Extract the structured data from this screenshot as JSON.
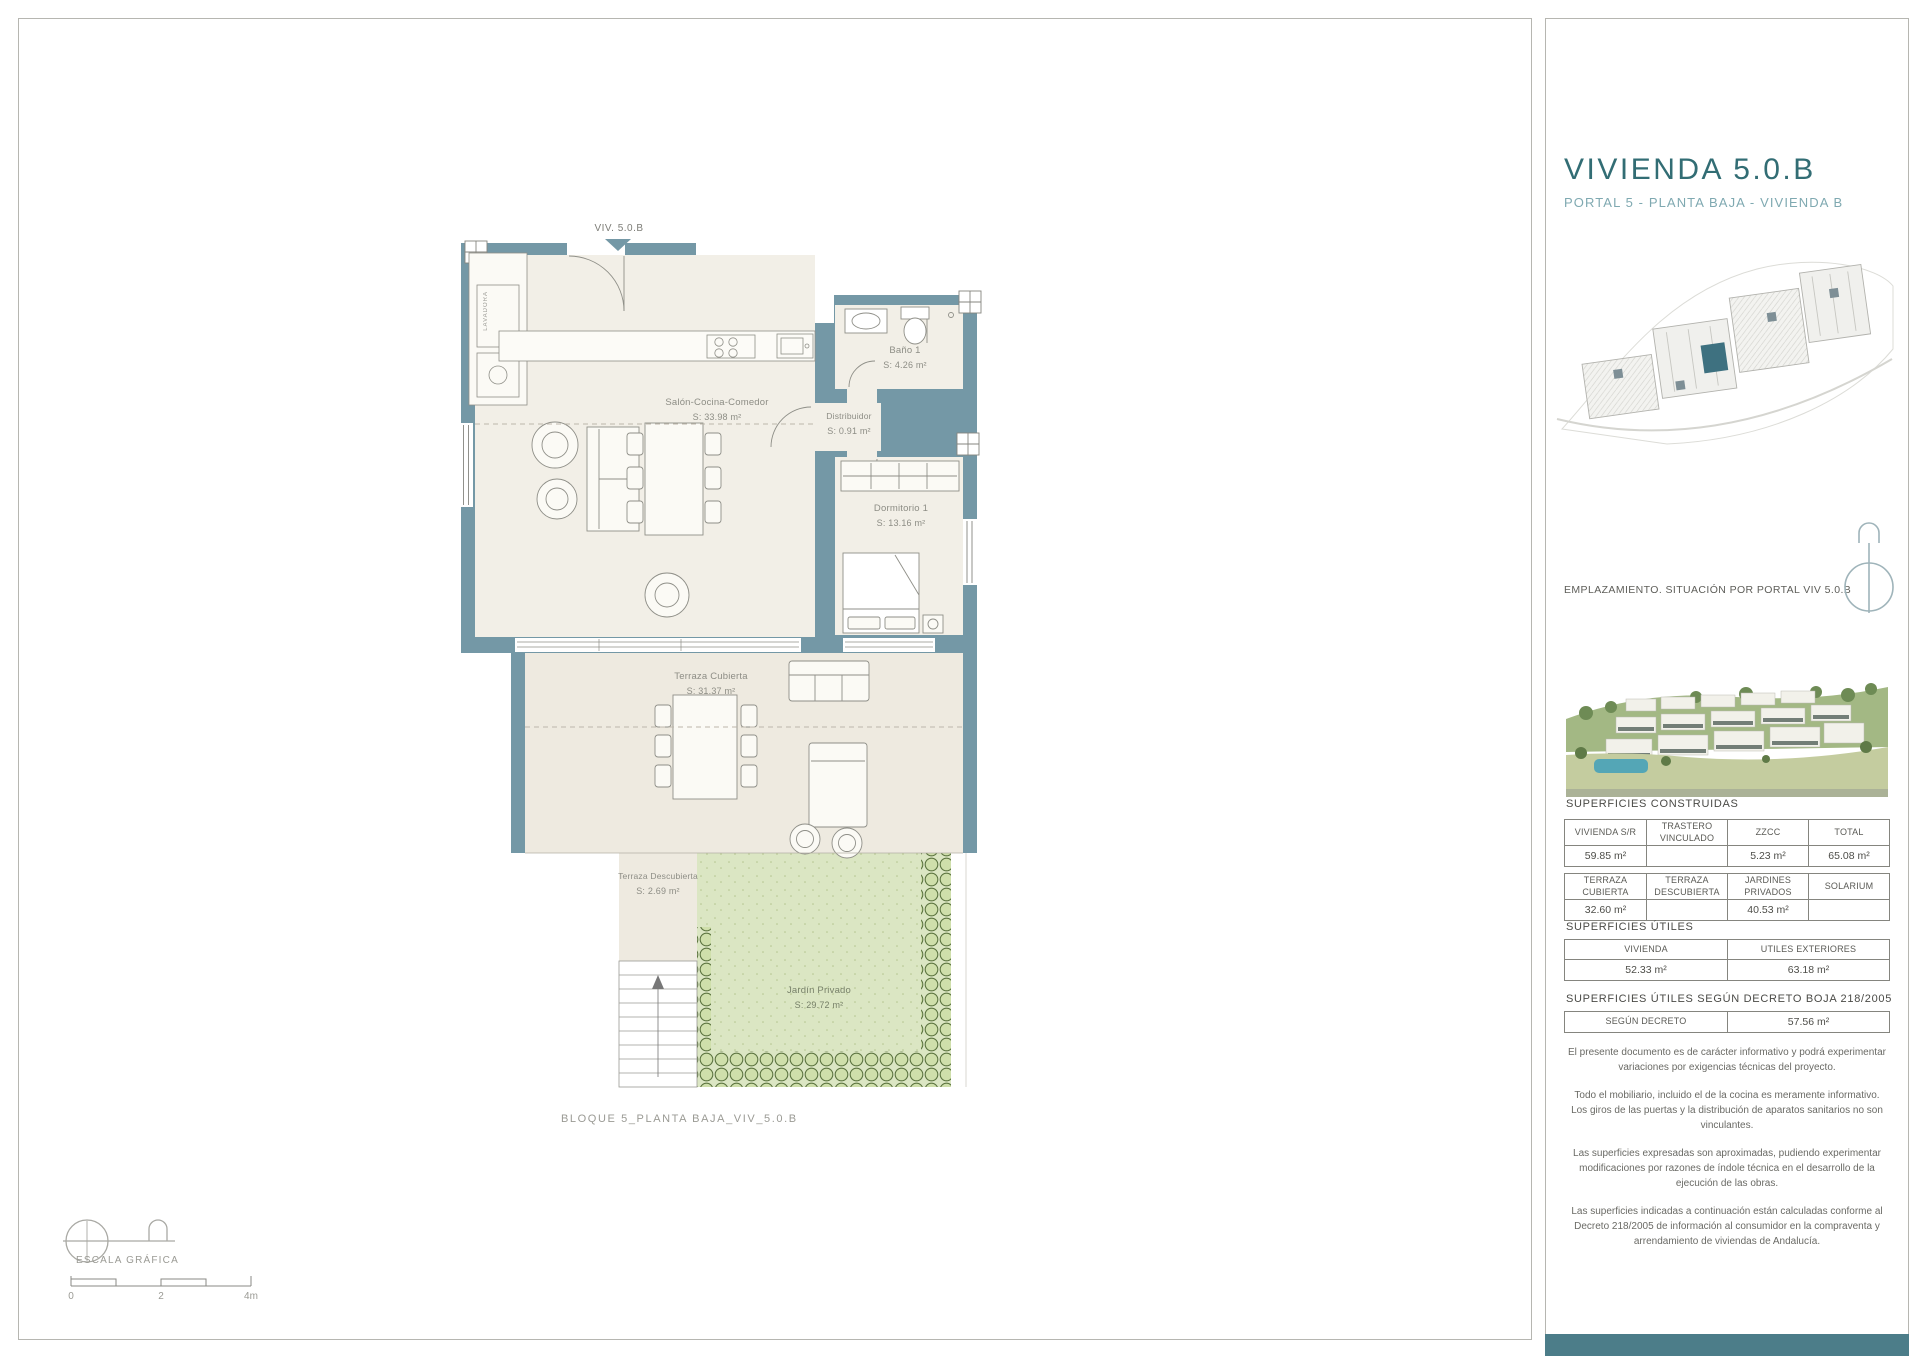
{
  "sheet": {
    "entry_label": "VIV. 5.0.B",
    "closet_label": "LAVADORA",
    "rooms": [
      {
        "name": "Salón-Cocina-Comedor",
        "area": "S: 33.98 m²"
      },
      {
        "name": "Baño 1",
        "area": "S: 4.26 m²"
      },
      {
        "name": "Distribuidor",
        "area": "S: 0.91 m²"
      },
      {
        "name": "Dormitorio 1",
        "area": "S: 13.16 m²"
      },
      {
        "name": "Terraza Cubierta",
        "area": "S: 31.37 m²"
      },
      {
        "name": "Terraza Descubierta",
        "area": "S: 2.69 m²"
      },
      {
        "name": "Jardín Privado",
        "area": "S: 29.72 m²"
      }
    ],
    "caption": "BLOQUE 5_PLANTA BAJA_VIV_5.0.B",
    "scale": {
      "label": "ESCALA GRÁFICA",
      "ticks": [
        "0",
        "2",
        "4m"
      ]
    }
  },
  "panel": {
    "title": "VIVIENDA 5.0.B",
    "subtitle": "PORTAL 5 - PLANTA BAJA - VIVIENDA B",
    "emplazamiento": "EMPLAZAMIENTO. SITUACIÓN POR PORTAL VIV 5.0.B",
    "construidas": {
      "heading": "SUPERFICIES CONSTRUIDAS",
      "t1": {
        "headers": [
          "VIVIENDA S/R",
          "TRASTERO VINCULADO",
          "ZZCC",
          "TOTAL"
        ],
        "values": [
          "59.85 m²",
          "",
          "5.23 m²",
          "65.08 m²"
        ]
      },
      "t2": {
        "headers": [
          "TERRAZA CUBIERTA",
          "TERRAZA DESCUBIERTA",
          "JARDINES PRIVADOS",
          "SOLARIUM"
        ],
        "values": [
          "32.60 m²",
          "",
          "40.53 m²",
          ""
        ]
      }
    },
    "utiles": {
      "heading": "SUPERFICIES ÚTILES",
      "headers": [
        "VIVIENDA",
        "UTILES EXTERIORES"
      ],
      "values": [
        "52.33 m²",
        "63.18 m²"
      ]
    },
    "decreto": {
      "heading": "SUPERFICIES ÚTILES SEGÚN DECRETO BOJA 218/2005",
      "header": "SEGÚN DECRETO",
      "value": "57.56 m²"
    },
    "disclaimers": [
      "El presente documento es de carácter informativo y podrá experimentar variaciones por exigencias técnicas del  proyecto.",
      "Todo el mobiliario, incluido el de la cocina es meramente informativo. Los giros de las puertas y la distribución de aparatos sanitarios no son vinculantes.",
      "Las superficies expresadas son aproximadas, pudiendo experimentar modificaciones por razones de índole técnica en el desarrollo de la ejecución de las obras.",
      "Las superficies indicadas a continuación están calculadas conforme al Decreto 218/2005 de  información al consumidor en la compraventa y arrendamiento de viviendas de Andalucía."
    ]
  },
  "colors": {
    "wall": "#7498a6",
    "floor": "#f2efe7",
    "terrace_floor": "#eeeae0",
    "garden": "#dbe6c3",
    "hedge": "#5c7440",
    "accent_dark": "#326d74",
    "accent_light": "#7fa9b1",
    "footer_bar": "#4c7d89",
    "site_highlight": "#3e7180"
  }
}
